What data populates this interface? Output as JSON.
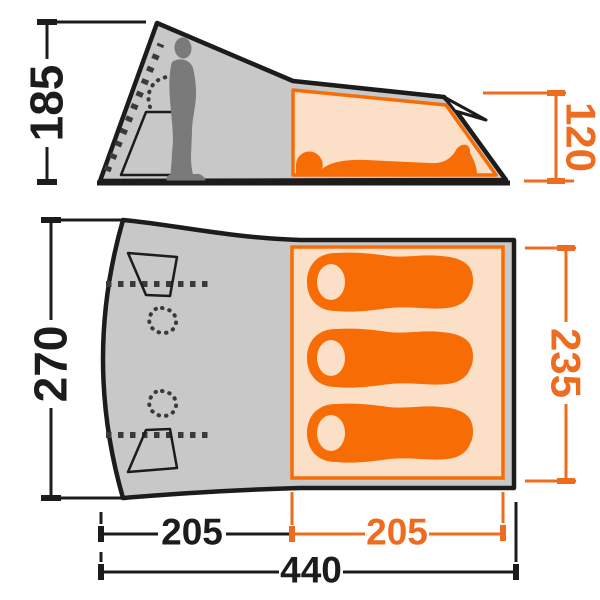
{
  "title": "Tent dimensions diagram (side view and floor plan)",
  "colors": {
    "ink": "#1c1c1c",
    "tent": "#c8c8c8",
    "figure": "#7a7a7a",
    "detail": "#3a3a3a",
    "accent": "#f86c05",
    "accent_light": "#fbdfc7",
    "dim_orange": "#ee6c20"
  },
  "dimensions": {
    "standing_height": "185",
    "cabin_height": "120",
    "tent_depth": "270",
    "cabin_length": "235",
    "porch_width": "205",
    "cabin_width": "205",
    "total_width": "440"
  }
}
